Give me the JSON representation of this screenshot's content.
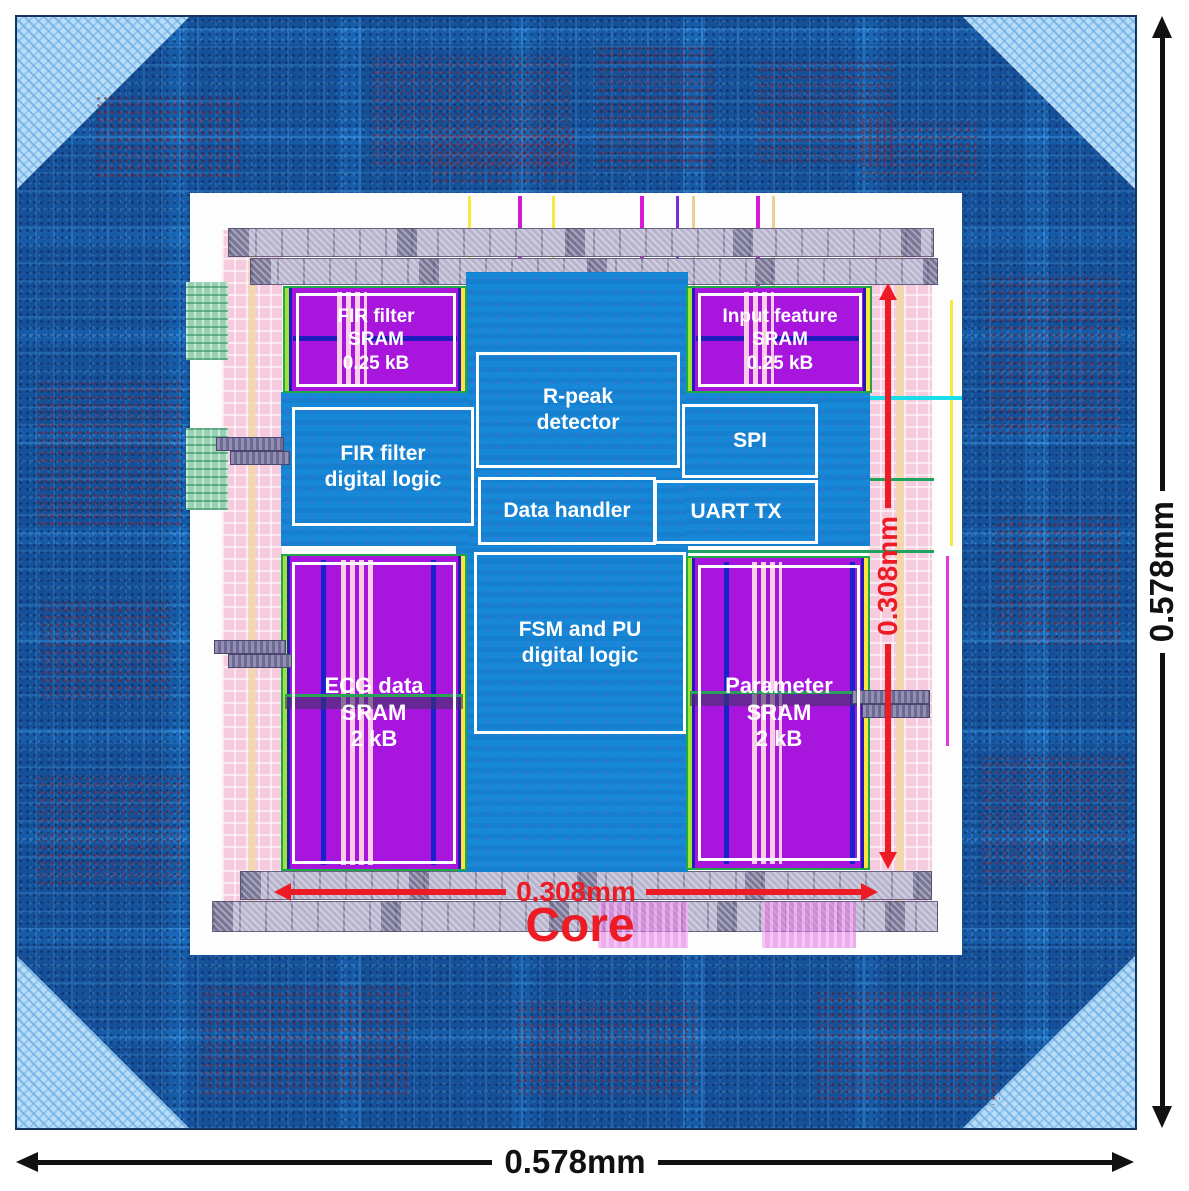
{
  "figure": {
    "core_label": "Core",
    "die_width": "0.578mm",
    "die_height": "0.578mm",
    "core_width": "0.308mm",
    "core_height": "0.308mm"
  },
  "blocks": {
    "fir_filter_sram": {
      "label": "FIR filter\nSRAM\n0.25 kB"
    },
    "input_feature_sram": {
      "label": "Input feature\nSRAM\n0.25 kB"
    },
    "fir_filter_logic": {
      "label": "FIR filter\ndigital logic"
    },
    "r_peak_detector": {
      "label": "R-peak\ndetector"
    },
    "data_handler": {
      "label": "Data handler"
    },
    "spi": {
      "label": "SPI"
    },
    "uart_tx": {
      "label": "UART TX"
    },
    "fsm_pu_logic": {
      "label": "FSM and PU\ndigital logic"
    },
    "ecg_data_sram": {
      "label": "ECG data\nSRAM\n2 kB"
    },
    "parameter_sram": {
      "label": "Parameter\nSRAM\n2 kB"
    }
  },
  "colors": {
    "annotation_red": "#ed1c24",
    "dimension_black": "#111111",
    "sram_purple": "#a816dd",
    "logic_blue": "#1787d7",
    "pad_ring_blue": "#1a67b6"
  }
}
